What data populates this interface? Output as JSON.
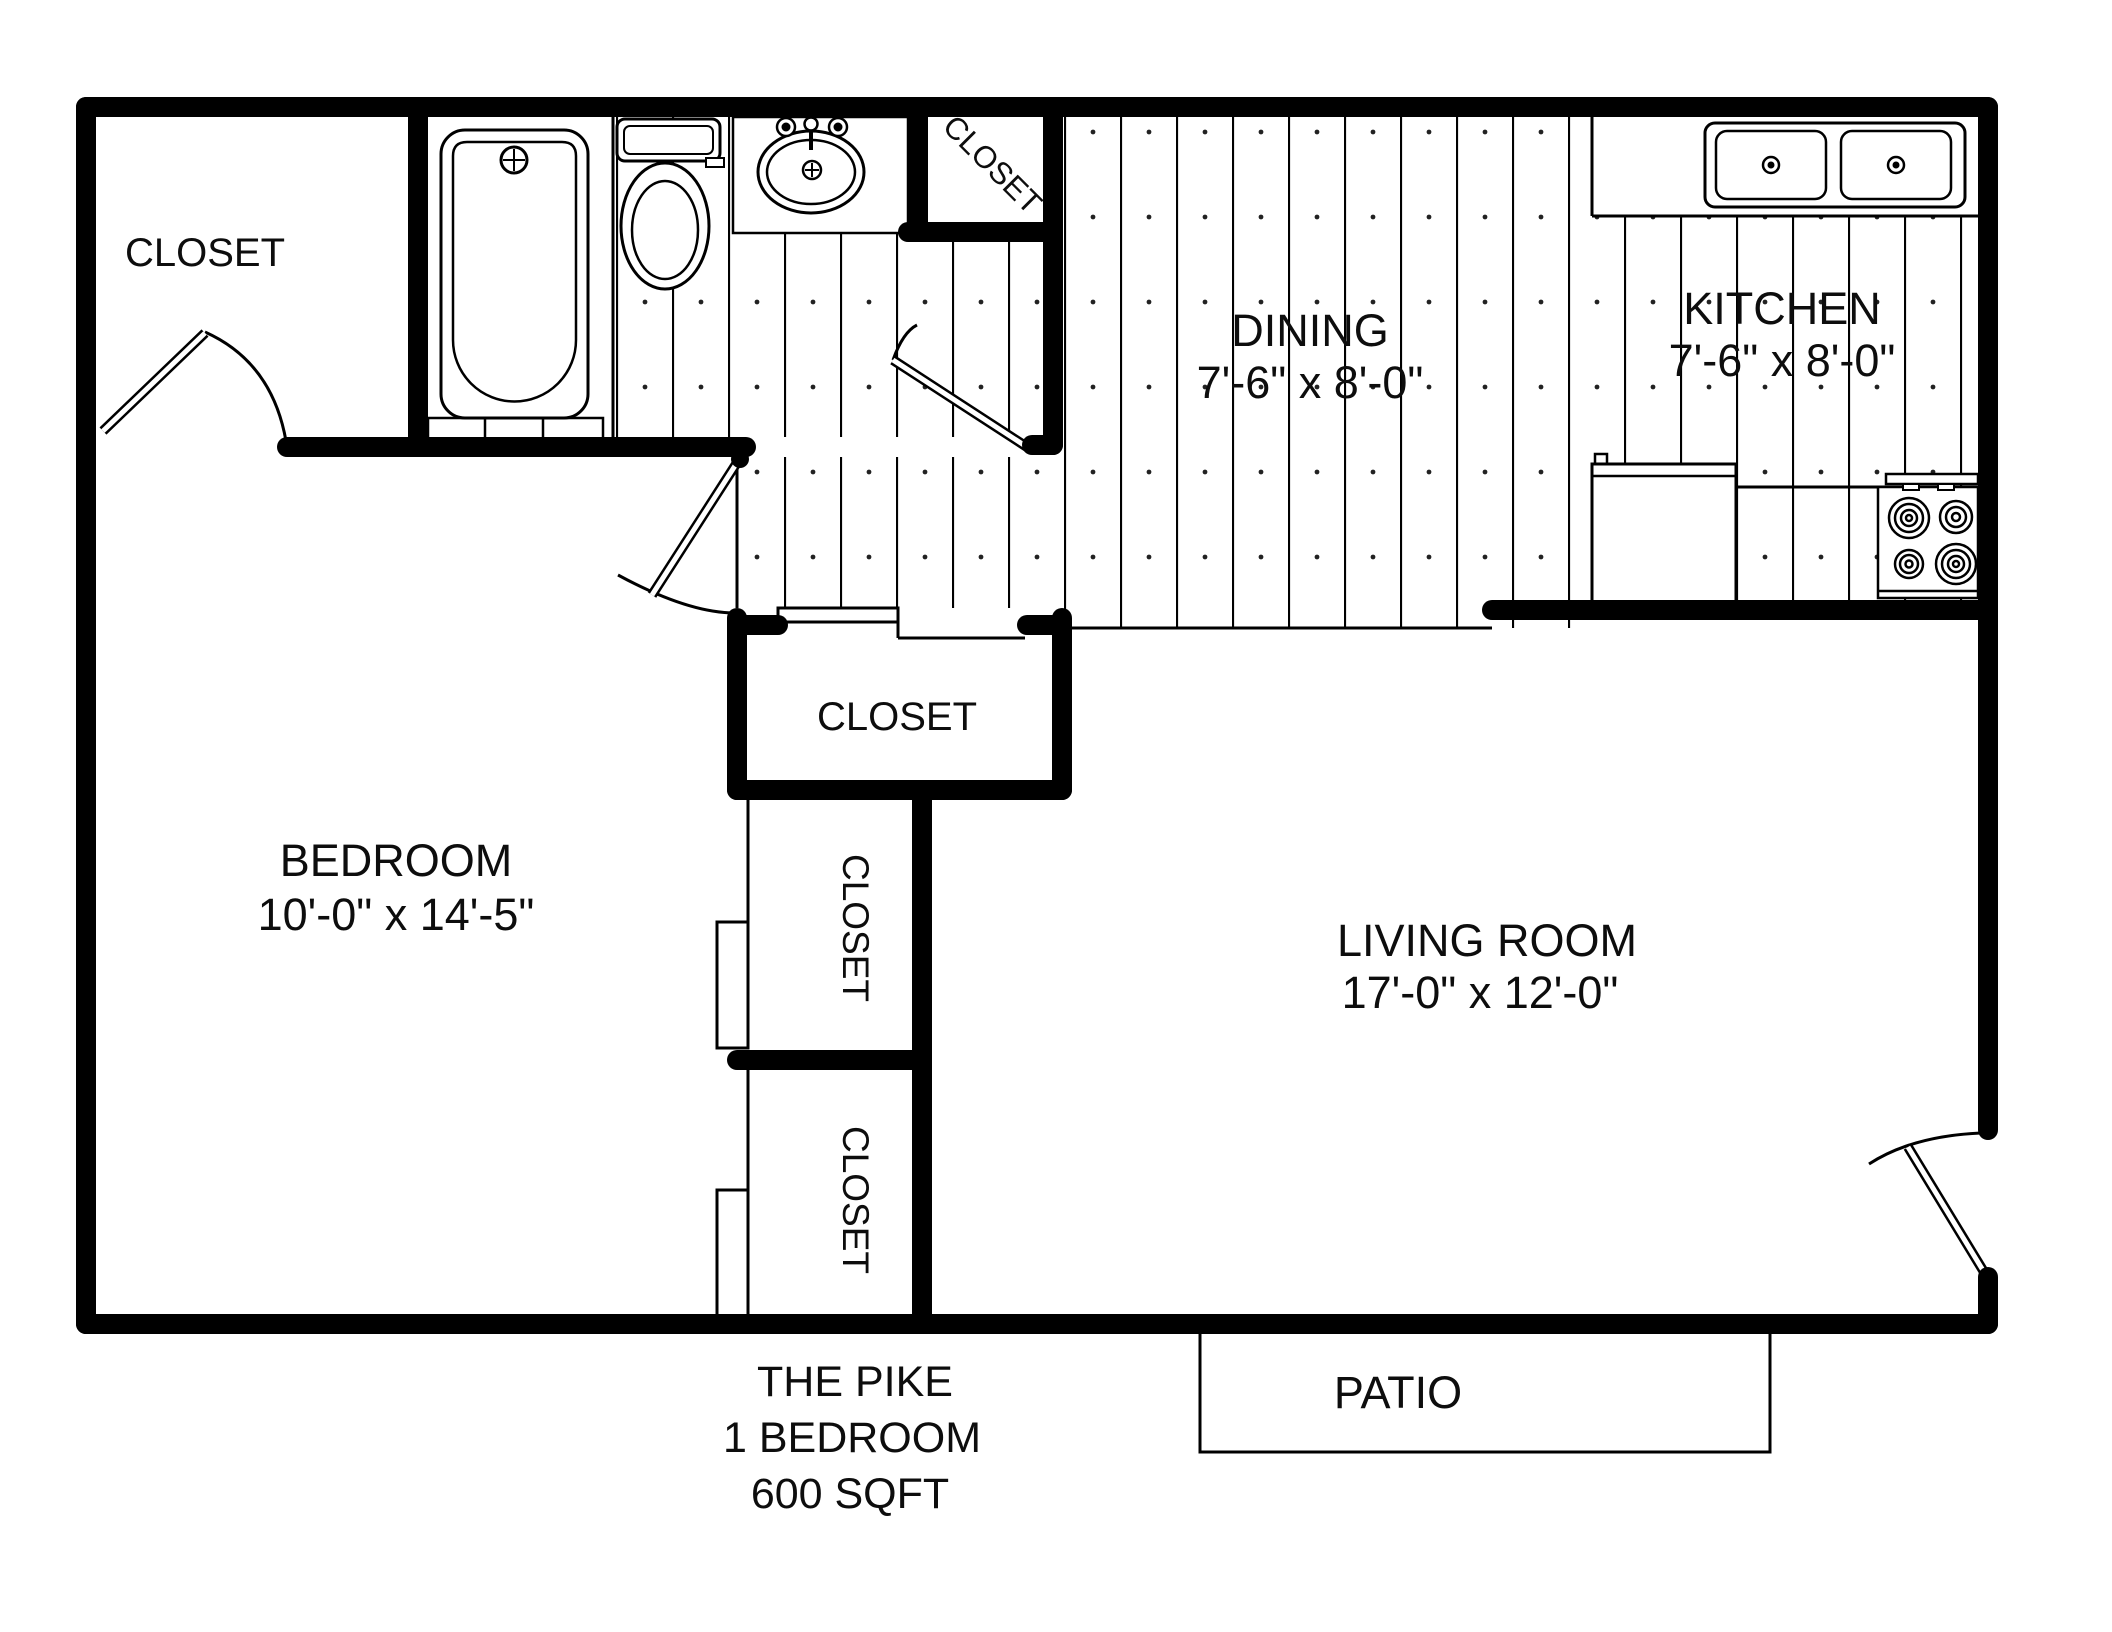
{
  "plan": {
    "title": "THE PIKE",
    "type": "1 BEDROOM",
    "area": "600 SQFT"
  },
  "rooms": {
    "closet_entry": "CLOSET",
    "closet_bath": "CLOSET",
    "closet_hall": "CLOSET",
    "closet_bedroom_upper": "CLOSET",
    "closet_bedroom_lower": "CLOSET",
    "dining": {
      "label": "DINING",
      "dims": "7'-6\" x 8'-0\""
    },
    "kitchen": {
      "label": "KITCHEN",
      "dims": "7'-6\" x 8'-0\""
    },
    "bedroom": {
      "label": "BEDROOM",
      "dims": "10'-0\" x 14'-5\""
    },
    "living": {
      "label": "LIVING ROOM",
      "dims": "17'-0\" x 12'-0\""
    },
    "patio": {
      "label": "PATIO"
    }
  },
  "colors": {
    "walls": "#000000",
    "background": "#ffffff",
    "text": "#0d0d0d"
  },
  "fixtures": [
    "bathtub",
    "toilet",
    "bathroom-sink",
    "kitchen-double-sink",
    "refrigerator",
    "stove"
  ]
}
